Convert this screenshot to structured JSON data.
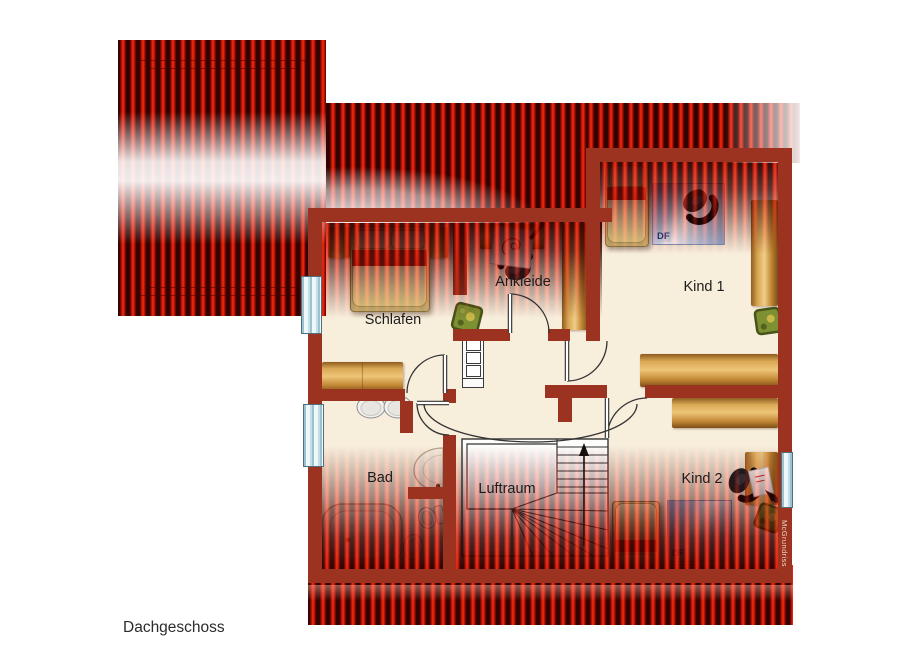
{
  "plan": {
    "floor_label": "Dachgeschoss",
    "watermark": "McGrundriss",
    "skylight_label": "DF",
    "rooms": {
      "schlafen": {
        "label": "Schlafen"
      },
      "ankleide": {
        "label": "Ankleide"
      },
      "kind1": {
        "label": "Kind 1"
      },
      "kind2": {
        "label": "Kind 2"
      },
      "bad": {
        "label": "Bad"
      },
      "luftraum": {
        "label": "Luftraum"
      }
    }
  },
  "colors": {
    "roof_red": "#e41102",
    "roof_stripe_dark": "#300300",
    "wall": "#9c3220",
    "floor": "#f8eedc",
    "wood": "#d9a855",
    "skylight_blue": "#b9cce8",
    "window_blue": "#cfe4ea",
    "luftraum_white": "#fdfdfc",
    "bed_red_band": "#b52616"
  }
}
